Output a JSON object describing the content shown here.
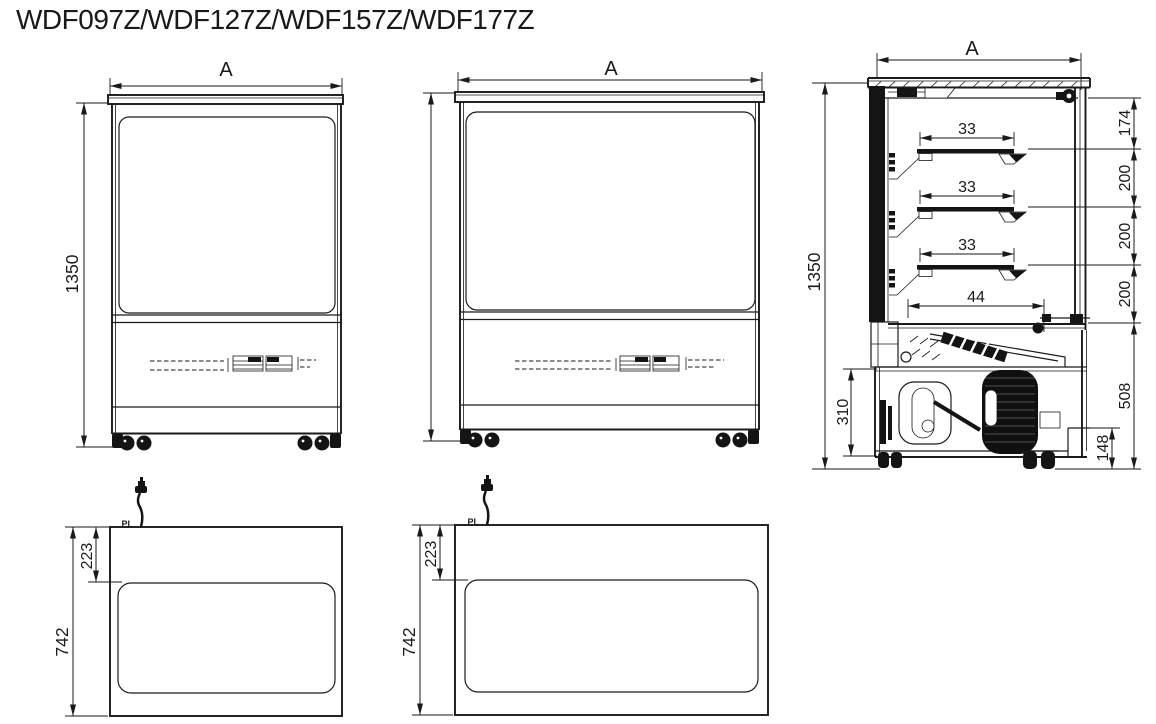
{
  "title": "WDF097Z/WDF127Z/WDF157Z/WDF177Z",
  "front_view_small": {
    "width_label": "A",
    "height_label": "1350"
  },
  "front_view_large": {
    "width_label": "A"
  },
  "side_view": {
    "width_label": "A",
    "height_label": "1350",
    "shelf_dims": [
      "33",
      "33",
      "33"
    ],
    "deck_dim": "44",
    "right_dims": [
      "174",
      "200",
      "200",
      "200",
      "508"
    ],
    "base_height_dim": "148",
    "machine_dim": "310"
  },
  "plan_view_small": {
    "depth_label": "742",
    "top_offset_label": "223",
    "plug_label": "PL"
  },
  "plan_view_large": {
    "depth_label": "742",
    "top_offset_label": "223",
    "plug_label": "PL"
  }
}
